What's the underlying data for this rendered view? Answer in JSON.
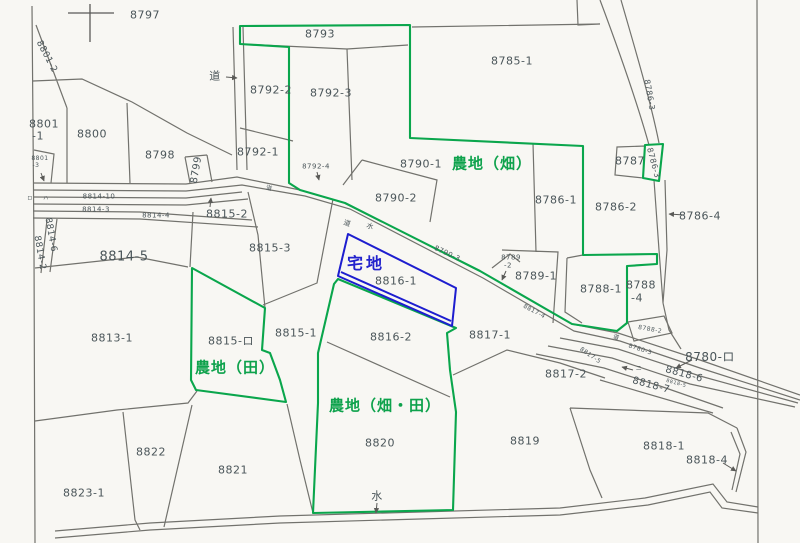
{
  "map": {
    "title": "cadastral-parcel-map",
    "colors": {
      "background": "#f8f7f3",
      "boundary_line": "#72726d",
      "highlight_green": "#0aa64c",
      "highlight_blue": "#1d1dcf",
      "number_text": "#4a5559",
      "green_text": "#0ea24c",
      "blue_text": "#2323cd"
    },
    "landuse_labels": {
      "hatake": "農地（畑）",
      "ta": "農地（田）",
      "hatake_ta": "農地（畑・田）",
      "takuchi": "宅地"
    },
    "labels": [
      {
        "t": "8797",
        "x": 145,
        "y": 15
      },
      {
        "t": "8793",
        "x": 320,
        "y": 34
      },
      {
        "t": "8785-1",
        "x": 512,
        "y": 61
      },
      {
        "t": "8801-2",
        "x": 46,
        "y": 57,
        "r": 62,
        "fs": 9
      },
      {
        "t": "道",
        "x": 215,
        "y": 76,
        "fs": 11,
        "n": "road-label"
      },
      {
        "t": "8792-2",
        "x": 271,
        "y": 90
      },
      {
        "t": "8792-3",
        "x": 331,
        "y": 93
      },
      {
        "t": "8786-3",
        "x": 649,
        "y": 95,
        "r": 80,
        "fs": 8
      },
      {
        "t": "8801",
        "x": 44,
        "y": 124
      },
      {
        "t": "-1",
        "x": 38,
        "y": 136
      },
      {
        "t": "8800",
        "x": 92,
        "y": 134
      },
      {
        "t": "8798",
        "x": 160,
        "y": 155
      },
      {
        "t": "8792-1",
        "x": 258,
        "y": 152
      },
      {
        "t": "8792-4",
        "x": 316,
        "y": 167,
        "fs": 7
      },
      {
        "t": "8799",
        "x": 197,
        "y": 170,
        "r": -80,
        "fs": 10
      },
      {
        "t": "8790-1",
        "x": 421,
        "y": 164
      },
      {
        "t": "農地（畑）",
        "x": 492,
        "y": 164,
        "c": "g",
        "n": "landuse-label-hatake"
      },
      {
        "t": "8787",
        "x": 630,
        "y": 161
      },
      {
        "t": "8786-3",
        "x": 653,
        "y": 163,
        "r": 75,
        "fs": 8
      },
      {
        "t": "8801",
        "x": 40,
        "y": 159,
        "fs": 6
      },
      {
        "t": "-3",
        "x": 36,
        "y": 166,
        "fs": 6
      },
      {
        "t": "8814-10",
        "x": 99,
        "y": 197,
        "fs": 7
      },
      {
        "t": "8814-3",
        "x": 96,
        "y": 210,
        "fs": 7
      },
      {
        "t": "8814-4",
        "x": 156,
        "y": 216,
        "fs": 7
      },
      {
        "t": "8815-2",
        "x": 227,
        "y": 214
      },
      {
        "t": "ロ",
        "x": 30,
        "y": 199,
        "fs": 5
      },
      {
        "t": "ハ",
        "x": 46,
        "y": 199,
        "fs": 5
      },
      {
        "t": "8814-6",
        "x": 50,
        "y": 235,
        "r": 80,
        "fs": 9
      },
      {
        "t": "8814-2",
        "x": 39,
        "y": 253,
        "r": 80,
        "fs": 9
      },
      {
        "t": "8814-5",
        "x": 124,
        "y": 257,
        "fs": 13
      },
      {
        "t": "8815-3",
        "x": 270,
        "y": 248
      },
      {
        "t": "8790-2",
        "x": 396,
        "y": 198
      },
      {
        "t": "道",
        "x": 269,
        "y": 189,
        "fs": 6,
        "r": 15,
        "n": "road-label"
      },
      {
        "t": "道",
        "x": 347,
        "y": 224,
        "fs": 7,
        "r": 20,
        "n": "road-label"
      },
      {
        "t": "水",
        "x": 370,
        "y": 227,
        "fs": 7,
        "r": 20,
        "n": "water-label"
      },
      {
        "t": "8790-3",
        "x": 447,
        "y": 254,
        "r": 25,
        "fs": 7
      },
      {
        "t": "8786-1",
        "x": 556,
        "y": 200
      },
      {
        "t": "8786-2",
        "x": 616,
        "y": 207
      },
      {
        "t": "8786-4",
        "x": 700,
        "y": 216
      },
      {
        "t": "宅地",
        "x": 366,
        "y": 264,
        "c": "b",
        "n": "landuse-label-takuchi"
      },
      {
        "t": "8816-1",
        "x": 396,
        "y": 281
      },
      {
        "t": "8789",
        "x": 511,
        "y": 258,
        "fs": 7
      },
      {
        "t": "-2",
        "x": 508,
        "y": 266,
        "fs": 7
      },
      {
        "t": "8789-1",
        "x": 536,
        "y": 276
      },
      {
        "t": "8788-1",
        "x": 601,
        "y": 289
      },
      {
        "t": "8788",
        "x": 641,
        "y": 285
      },
      {
        "t": "-4",
        "x": 637,
        "y": 298
      },
      {
        "t": "8788-2",
        "x": 650,
        "y": 330,
        "fs": 6,
        "r": 10
      },
      {
        "t": "道",
        "x": 616,
        "y": 338,
        "fs": 6,
        "r": 20,
        "n": "road-label"
      },
      {
        "t": "8780-3",
        "x": 640,
        "y": 350,
        "r": 18,
        "fs": 6
      },
      {
        "t": "8780-ロ",
        "x": 710,
        "y": 357,
        "fs": 12
      },
      {
        "t": "8817-5",
        "x": 590,
        "y": 356,
        "r": 35,
        "fs": 6
      },
      {
        "t": "8817-2",
        "x": 566,
        "y": 374
      },
      {
        "t": "8818-6",
        "x": 684,
        "y": 375,
        "r": 15,
        "fs": 10
      },
      {
        "t": "8818-5",
        "x": 676,
        "y": 384,
        "r": 15,
        "fs": 5
      },
      {
        "t": "8818-7",
        "x": 651,
        "y": 386,
        "r": 15,
        "fs": 10
      },
      {
        "t": "ニ",
        "x": 639,
        "y": 369,
        "fs": 6
      },
      {
        "t": "8817-1",
        "x": 490,
        "y": 335
      },
      {
        "t": "8817-4",
        "x": 534,
        "y": 312,
        "r": 28,
        "fs": 6
      },
      {
        "t": "8813-1",
        "x": 112,
        "y": 338
      },
      {
        "t": "8815-ロ",
        "x": 231,
        "y": 341
      },
      {
        "t": "8815-1",
        "x": 296,
        "y": 333
      },
      {
        "t": "農地（田）",
        "x": 235,
        "y": 368,
        "c": "g",
        "n": "landuse-label-ta"
      },
      {
        "t": "8816-2",
        "x": 391,
        "y": 337
      },
      {
        "t": "農地（畑・田）",
        "x": 385,
        "y": 406,
        "c": "g",
        "n": "landuse-label-hatake-ta"
      },
      {
        "t": "8820",
        "x": 380,
        "y": 443
      },
      {
        "t": "8819",
        "x": 525,
        "y": 441
      },
      {
        "t": "8818-1",
        "x": 664,
        "y": 446
      },
      {
        "t": "8818-4",
        "x": 707,
        "y": 460
      },
      {
        "t": "8821",
        "x": 233,
        "y": 470
      },
      {
        "t": "8822",
        "x": 151,
        "y": 452
      },
      {
        "t": "8823-1",
        "x": 84,
        "y": 493
      },
      {
        "t": "水",
        "x": 377,
        "y": 496,
        "n": "water-label"
      }
    ]
  }
}
